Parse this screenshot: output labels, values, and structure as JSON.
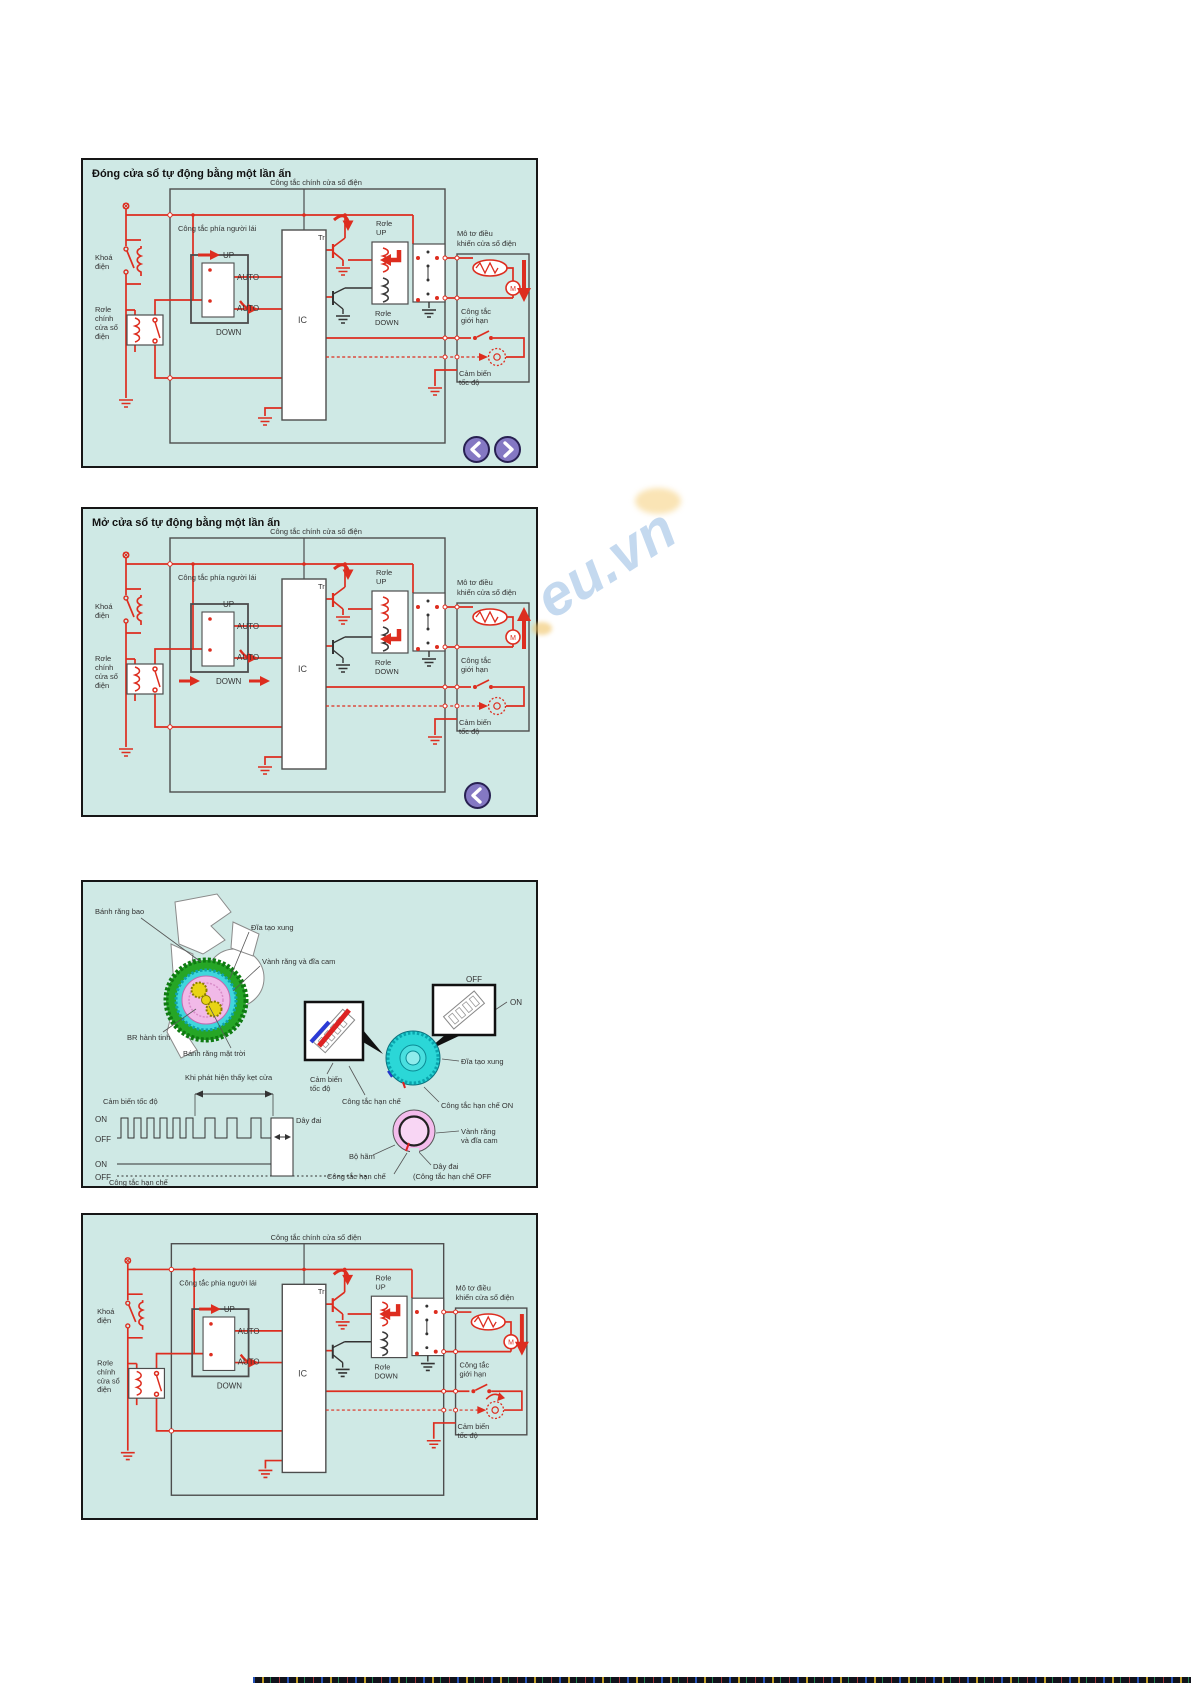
{
  "page": {
    "watermark_text": "eu.vn"
  },
  "colors": {
    "panel_background": "#cfe9e5",
    "wire_red": "#dd2d1f",
    "line_dark": "#4d4d4d",
    "nav_button_purple": "#8478c3",
    "gear_green": "#26a626",
    "gear_cyan": "#2bd7d7",
    "gear_pink": "#f3bcec",
    "gear_yellow": "#e8d414",
    "watermark_blue": "#94bae2"
  },
  "panel_close": {
    "title": "Đóng cửa sổ tự động bằng một lần ấn"
  },
  "panel_open": {
    "title": "Mở cửa sổ tự động bằng một lần ấn"
  },
  "circuit": {
    "main_switch_label": "Công tắc chính cửa sổ điện",
    "ignition_line1": "Khoá",
    "ignition_line2": "điện",
    "main_relay_line1": "Rơle",
    "main_relay_line2": "chính",
    "main_relay_line3": "cửa sổ",
    "main_relay_line4": "điện",
    "driver_switch_label": "Công tắc phía người lái",
    "up": "UP",
    "auto_a": "AUTO",
    "auto_b": "AUTO",
    "down": "DOWN",
    "ic": "IC",
    "tr": "Tr",
    "relay_up_line1": "Rơle",
    "relay_up_line2": "UP",
    "relay_down_line1": "Rơle",
    "relay_down_line2": "DOWN",
    "motor_line1": "Mô tơ điều",
    "motor_line2": "khiển cửa sổ điện",
    "motor_m": "M",
    "limit_line1": "Công tắc",
    "limit_line2": "giới hạn",
    "sensor_line1": "Cảm biến",
    "sensor_line2": "tốc độ"
  },
  "mech": {
    "ring_gear": "Bánh răng bao",
    "pulse_disc": "Đĩa tạo xung",
    "cam_ring": "Vành răng và đĩa cam",
    "planet_gear": "BR hành tinh",
    "sun_gear": "Bánh răng mặt trời",
    "jam_detect": "Khi phát hiện thấy kẹt cửa",
    "speed_sensor": "Cảm biến tốc độ",
    "on1": "ON",
    "off1": "OFF",
    "on2": "ON",
    "off2": "OFF",
    "belt": "Dây đai",
    "limit_switch": "Công tắc hạn chế",
    "inset_off": "OFF",
    "inset_on": "ON",
    "sensor2_line1": "Cảm biến",
    "sensor2_line2": "tốc độ",
    "limit_mid": "Công tắc hạn chế",
    "pulse_disc2": "Đĩa tạo xung",
    "limit_on": "Công tắc hạn chế ON",
    "cam_ring2_line1": "Vành răng",
    "cam_ring2_line2": "và đĩa cam",
    "brake": "Bộ hãm",
    "belt2": "Dây đai",
    "limit_off": "(Công tắc hạn chế OFF",
    "limit_bottom": "Công tắc hạn chế"
  }
}
